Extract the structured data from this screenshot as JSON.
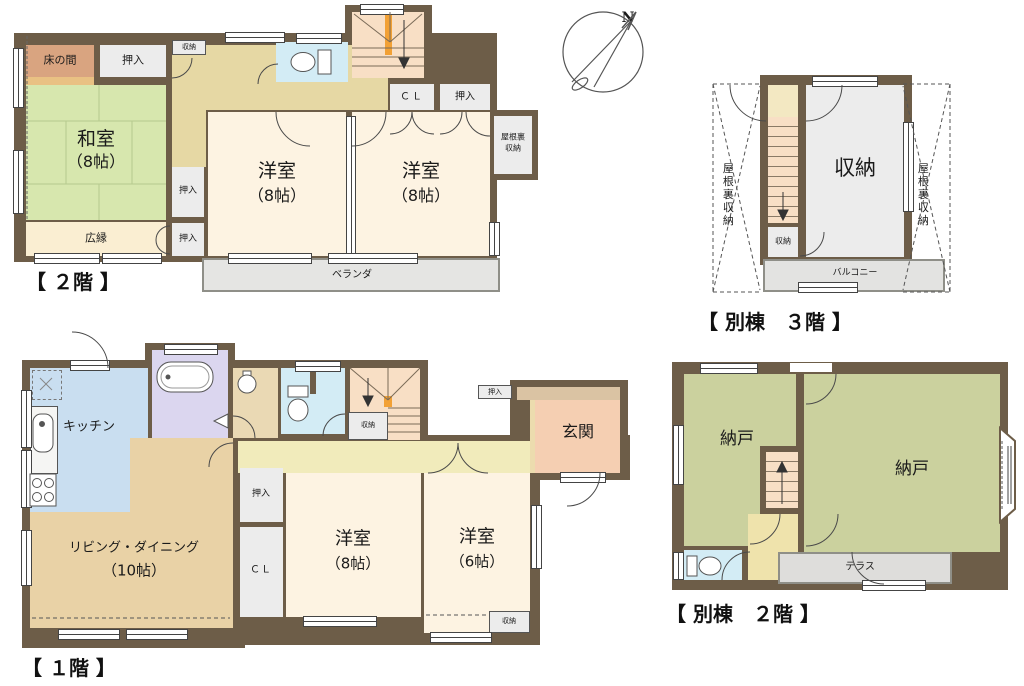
{
  "page_type": "japanese-floorplan",
  "compass": {
    "north_label": "N"
  },
  "colors": {
    "wall": "#6d5d48",
    "tatami": "#d7e7ae",
    "cream_room": "#fdf3e2",
    "closet_gray": "#ececec",
    "hall_tan": "#e6d8a4",
    "hall_yellow": "#f1ebbb",
    "stairs_salmon": "#f8dfc5",
    "stairs_marker_orange": "#f2a135",
    "toilet_blue": "#d3ecf5",
    "kitchen_blue": "#c9def0",
    "bath_purple": "#dbd6ef",
    "living_tan": "#e9d2a6",
    "genkan_pink": "#f5cfb2",
    "porch_tan": "#dac3a3",
    "nando_green": "#cbd19e",
    "terrace_gray": "#dedddb",
    "balcony_gray": "#e3e3e1",
    "veranda_gray": "#e5e5e3",
    "hiroen_cream": "#faeed2",
    "tokonoma_pink": "#d9a480"
  },
  "floor2": {
    "title": "【 ２階 】",
    "rooms": {
      "tokonoma": {
        "label": "床の間"
      },
      "oshiire_top": {
        "label": "押入"
      },
      "hall_storage": {
        "label": "収納"
      },
      "washitsu": {
        "name": "和室",
        "size": "（8帖）"
      },
      "oshiire_mid": {
        "label": "押入"
      },
      "oshiire_bottom": {
        "label": "押入"
      },
      "hiroen": {
        "label": "広縁"
      },
      "yoshitsu_left": {
        "name": "洋室",
        "size": "（8帖）"
      },
      "yoshitsu_right": {
        "name": "洋室",
        "size": "（8帖）"
      },
      "closet": {
        "label": "ＣＬ"
      },
      "oshiire_right": {
        "label": "押入"
      },
      "attic_storage": {
        "line1": "屋根裏",
        "line2": "収納"
      },
      "veranda": {
        "label": "ベランダ"
      }
    }
  },
  "annex3": {
    "title": "【 別棟　３階 】",
    "rooms": {
      "attic_left": {
        "label": "屋根裏収納"
      },
      "attic_right": {
        "label": "屋根裏収納"
      },
      "storage_main": {
        "label": "収納"
      },
      "storage_small": {
        "label": "収納"
      },
      "balcony": {
        "label": "バルコニー"
      }
    }
  },
  "floor1": {
    "title": "【 １階 】",
    "rooms": {
      "kitchen": {
        "label": "キッチン"
      },
      "living": {
        "name": "リビング・ダイニング",
        "size": "（10帖）"
      },
      "oshiire": {
        "label": "押入"
      },
      "closet": {
        "label": "ＣＬ"
      },
      "stair_storage": {
        "label": "収納"
      },
      "oshiire_top": {
        "label": "押入"
      },
      "genkan": {
        "label": "玄関"
      },
      "yoshitsu8": {
        "name": "洋室",
        "size": "（8帖）"
      },
      "yoshitsu6": {
        "name": "洋室",
        "size": "（6帖）"
      },
      "storage_corner": {
        "label": "収納"
      }
    }
  },
  "annex2": {
    "title": "【 別棟　２階 】",
    "rooms": {
      "nando_left": {
        "label": "納戸"
      },
      "nando_right": {
        "label": "納戸"
      },
      "terrace": {
        "label": "テラス"
      }
    }
  }
}
